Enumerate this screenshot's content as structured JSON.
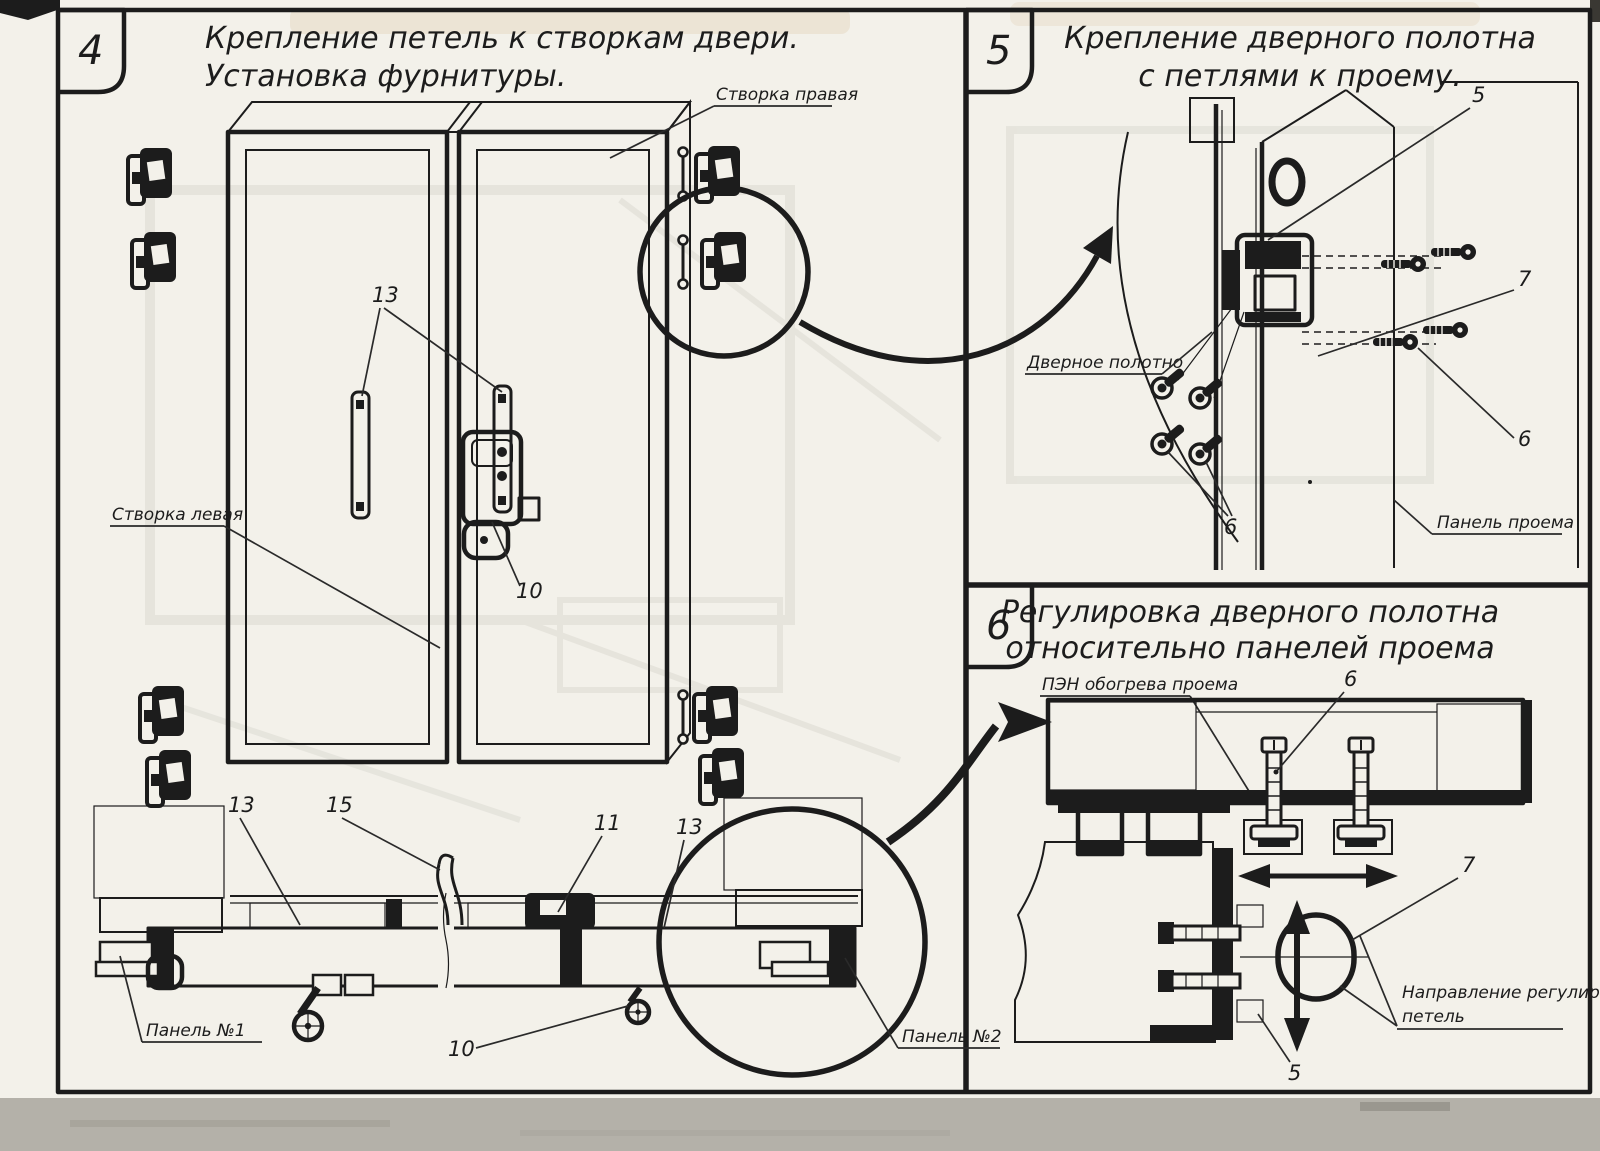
{
  "document": {
    "type": "scanned technical assembly drawing",
    "colors": {
      "paper": "#f3f1ea",
      "ink": "#1c1c1c",
      "scanner_band": "#b4b1a9"
    }
  },
  "panel4": {
    "number": "4",
    "title1": "Крепление петель к створкам двери.",
    "title2": "Установка фурнитуры.",
    "label_right_leaf": "Створка правая",
    "label_left_leaf": "Створка левая",
    "label_panel1": "Панель №1",
    "label_panel2": "Панель №2",
    "callouts": {
      "hinge_plates": "13",
      "latch": "10",
      "section_left": "13",
      "handle": "15",
      "lock": "11",
      "section_right": "13",
      "roller": "10"
    }
  },
  "panel5": {
    "number": "5",
    "title1": "Крепление дверного полотна",
    "title2": "с петлями к проему.",
    "label_door_leaf": "Дверное полотно",
    "label_opening_panel": "Панель проема",
    "callouts": {
      "top": "5",
      "middle": "7",
      "right": "6",
      "left": "6"
    }
  },
  "panel6": {
    "number": "6",
    "title1": "Регулировка дверного полотна",
    "title2": "относительно панелей проема",
    "label_heater": "ПЭН обогрева проема",
    "label_direction1": "Направление регулировки",
    "label_direction2": "петель",
    "callouts": {
      "bolt": "6",
      "loop": "7",
      "bottom": "5"
    }
  }
}
